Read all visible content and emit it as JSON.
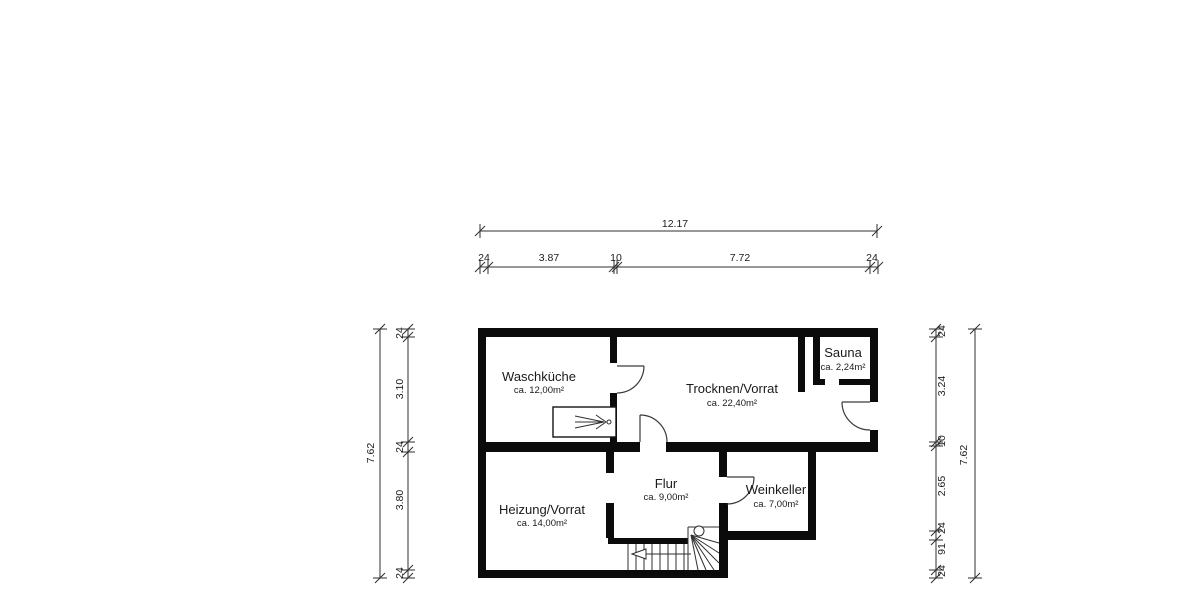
{
  "plan": {
    "rooms": {
      "waschkueche": {
        "name": "Waschküche",
        "area": "ca. 12,00m²"
      },
      "trocknen": {
        "name": "Trocknen/Vorrat",
        "area": "ca. 22,40m²"
      },
      "sauna": {
        "name": "Sauna",
        "area": "ca. 2,24m²"
      },
      "heizung": {
        "name": "Heizung/Vorrat",
        "area": "ca. 14,00m²"
      },
      "flur": {
        "name": "Flur",
        "area": "ca. 9,00m²"
      },
      "weinkeller": {
        "name": "Weinkeller",
        "area": "ca. 7,00m²"
      }
    },
    "dimensions": {
      "top": {
        "overall": "12.17",
        "segments": [
          "24",
          "3.87",
          "10",
          "7.72",
          "24"
        ]
      },
      "left": {
        "overall": "7.62",
        "segments": [
          "24",
          "3.10",
          "24",
          "3.80",
          "24"
        ]
      },
      "right": {
        "overall": "7.62",
        "segments": [
          "24",
          "3.24",
          "10",
          "2.65",
          "24",
          "91",
          "24"
        ]
      }
    },
    "colors": {
      "wall": "#0b0b0b",
      "line": "#2f2f2f",
      "text": "#1a1a1a",
      "background": "#ffffff"
    }
  }
}
